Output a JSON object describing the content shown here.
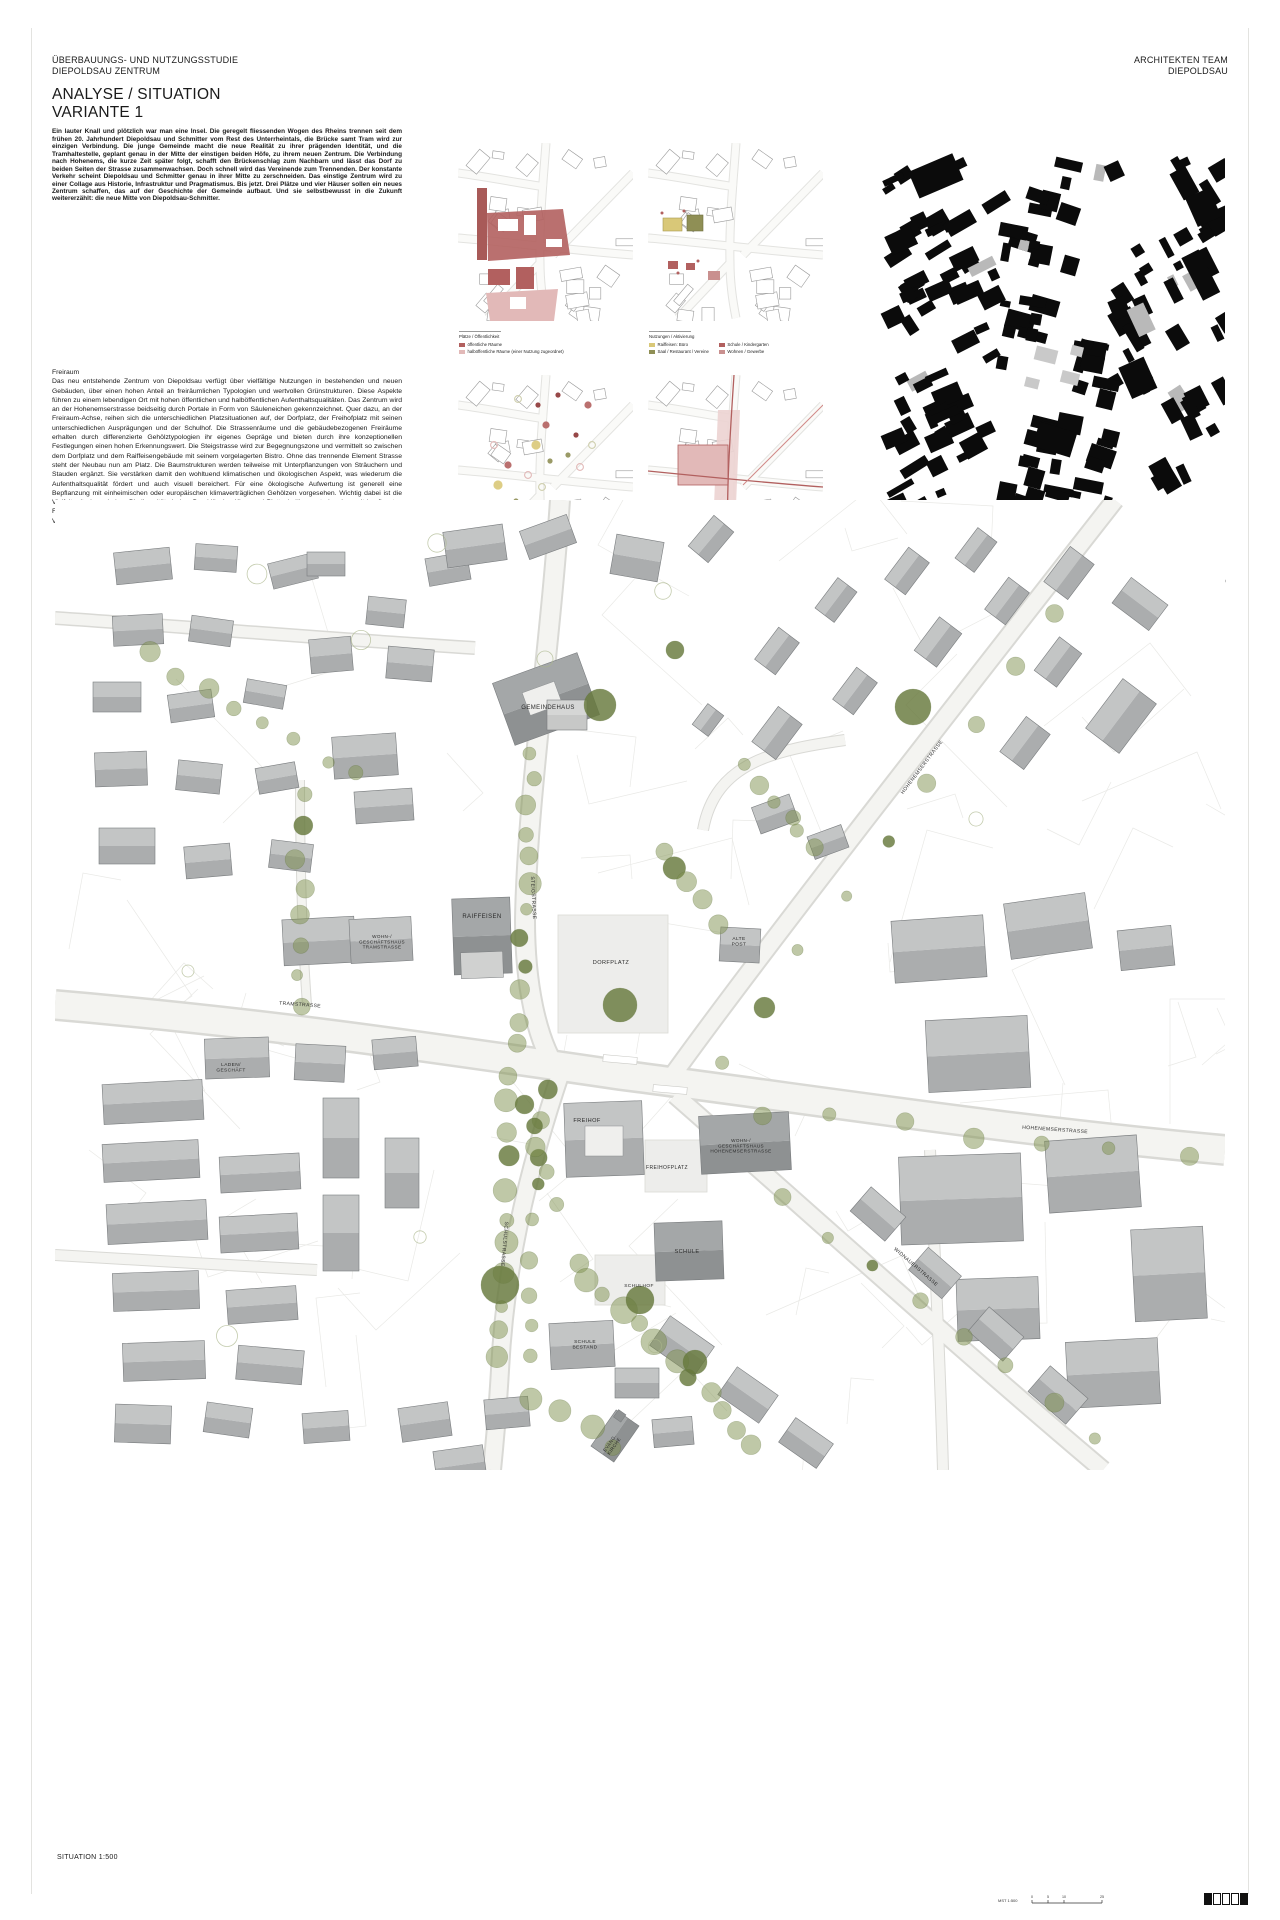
{
  "header": {
    "left1": "ÜBERBAUUNGS- UND NUTZUNGSSTUDIE",
    "left2": "DIEPOLDSAU ZENTRUM",
    "right1": "ARCHITEKTEN TEAM",
    "right2": "DIEPOLDSAU",
    "title1": "ANALYSE / SITUATION",
    "title2": "VARIANTE 1"
  },
  "intro_paragraph": "Ein lauter Knall und plötzlich war man eine Insel. Die geregelt fliessenden Wogen des Rheins trennen seit dem frühen 20. Jahrhundert Diepoldsau und Schmitter vom Rest des Unterrheintals, die Brücke samt Tram wird zur einzigen Verbindung. Die junge Gemeinde macht die neue Realität zu ihrer prägenden Identität, und die Tramhaltestelle, geplant genau in der Mitte der einstigen beiden Höfe, zu ihrem neuen Zentrum. Die Verbindung nach Hohenems, die kurze Zeit später folgt, schafft den Brückenschlag zum Nachbarn und lässt das Dorf zu beiden Seiten der Strasse zusammenwachsen. Doch schnell wird das Vereinende zum Trennenden. Der konstante Verkehr scheint Diepoldsau und Schmitter genau in ihrer Mitte zu zerschneiden. Das einstige Zentrum wird zu einer Collage aus Historie, Infrastruktur und Pragmatismus. Bis jetzt. Drei Plätze und vier Häuser sollen ein neues Zentrum schaffen, das auf der Geschichte der Gemeinde aufbaut. Und sie selbstbewusst in die Zukunft weitererzählt: die neue Mitte von Diepoldsau-Schmitter.",
  "freiraum": {
    "heading": "Freiraum",
    "body": "Das neu entstehende Zentrum von Diepoldsau verfügt über vielfältige Nutzungen in bestehenden und neuen Gebäuden, über einen hohen Anteil an freiräumlichen Typologien und wertvollen Grünstrukturen. Diese Aspekte führen zu einem lebendigen Ort mit hohen öffentlichen und halböffentlichen Aufenthaltsqualitäten. Das Zentrum wird an der Hohenemserstrasse beidseitig durch Portale in Form von Säuleneichen gekennzeichnet. Quer dazu, an der Freiraum-Achse, reihen sich die unterschiedlichen Platzsituationen auf, der Dorfplatz, der Freihofplatz mit seinen unterschiedlichen Ausprägungen und der Schulhof. Die Strassenräume und die gebäudebezogenen Freiräume erhalten durch differenzierte Gehölztypologien ihr eigenes Gepräge und bieten durch ihre konzeptionellen Festlegungen einen hohen Erkennungswert. Die Steigstrasse wird zur Begegnungszone und vermittelt so zwischen dem Dorfplatz und dem Raiffeisengebäude mit seinem vorgelagerten Bistro. Ohne das trennende Element Strasse steht der Neubau nun am Platz. Die Baumstrukturen werden teilweise mit Unterpflanzungen von Sträuchern und Stauden ergänzt. Sie verstärken damit den wohltuend klimatischen und ökologischen Aspekt, was wiederum die Aufenthaltsqualität fördert und auch visuell bereichert. Für eine ökologische Aufwertung ist generell eine Bepflanzung mit einheimischen oder europäischen klimaverträglichen Gehölzen vorgesehen. Wichtig dabei ist die Vielfalt mit einem hohen Biodiversitäts-Index. Durchlässige Kies- und Plattenbeläge, unterbrochen mit bepflanzten Fugen sowie Retentionsmulden und extensive Dachbegrünungen mit differenzierten Ansaaten tragen zur Verbesserung des Mikroklimas bei."
  },
  "legends": [
    {
      "cols": "c1",
      "title": "Plätze / Öffentlichkeit",
      "items": [
        {
          "shape": "rect",
          "color": "#b2605f",
          "label": "öffentliche Räume"
        },
        {
          "shape": "rect",
          "color": "#e2b9b8",
          "label": "halböffentliche Räume (einer Nutzung zugeordnet)"
        }
      ]
    },
    {
      "cols": "c2",
      "title": "Nutzungen / Aktivierung",
      "items": [
        {
          "shape": "rect",
          "color": "#d9c878",
          "label": "Raiffeisen: Büro"
        },
        {
          "shape": "rect",
          "color": "#8f8f55",
          "label": "Saal / Restaurant / Vereine"
        },
        {
          "shape": "rect",
          "color": "#b2605f",
          "label": "Schule / Kindergarten"
        },
        {
          "shape": "rect",
          "color": "#c9908f",
          "label": "Wohnen / Gewerbe"
        }
      ]
    },
    {
      "cols": "c3",
      "title": "Gehölzstrukturen",
      "items": [
        {
          "shape": "dot",
          "color": "#8c3434",
          "label": "Einzelbaum"
        },
        {
          "shape": "dot",
          "color": "#b2605f",
          "label": "Baumgruppen"
        },
        {
          "shape": "ring",
          "color": "#e2b9b8",
          "label": "Baumgruppen Aufenthalt"
        },
        {
          "shape": "dot",
          "color": "#d9c878",
          "label": "Solitärbaum"
        },
        {
          "shape": "dot",
          "color": "#8f8f55",
          "label": "Baumreihen"
        },
        {
          "shape": "ring",
          "color": "#cfcfae",
          "label": "Baumbestand"
        }
      ]
    },
    {
      "cols": "c1",
      "title": "Durchwegung",
      "items": [
        {
          "shape": "rect",
          "color": "#b2605f",
          "label": "Wege"
        },
        {
          "shape": "rect",
          "color": "#e2b9b8",
          "label": "Plätze"
        }
      ]
    }
  ],
  "schwarzplan": {
    "caption": "SCHWARZPLAN 1:2000"
  },
  "site_plan": {
    "scale_label": "SITUATION 1:500",
    "scalebar": {
      "prefix": "MST 1:500",
      "ticks": [
        "0",
        "5",
        "10",
        "25"
      ]
    },
    "labels": [
      {
        "id": "gemeindehaus",
        "text": "GEMEINDEHAUS",
        "x": 493,
        "y": 209,
        "size": 6,
        "rot": 0
      },
      {
        "id": "raiffeisen",
        "text": "RAIFFEISEN",
        "x": 427,
        "y": 418,
        "size": 6,
        "rot": 0
      },
      {
        "id": "wohnhaus-west",
        "text": "WOHN-/\nGESCHÄFTSHAUS\nTRAMSTRASSE",
        "x": 327,
        "y": 438,
        "size": 4.6,
        "rot": 0
      },
      {
        "id": "alte-post",
        "text": "ALTE\nPOST",
        "x": 684,
        "y": 440,
        "size": 4.8,
        "rot": 0
      },
      {
        "id": "dorfplatz",
        "text": "DORFPLATZ",
        "x": 556,
        "y": 464,
        "size": 5.6,
        "rot": 0
      },
      {
        "id": "tramstrasse",
        "text": "TRAMSTRASSE",
        "x": 245,
        "y": 506,
        "size": 5,
        "rot": 4
      },
      {
        "id": "steigstrasse",
        "text": "STEIGSTRASSE",
        "x": 477,
        "y": 398,
        "size": 5,
        "rot": 87
      },
      {
        "id": "laden",
        "text": "LADEN/\nGESCHÄFT",
        "x": 176,
        "y": 566,
        "size": 4.8,
        "rot": 0
      },
      {
        "id": "freihof",
        "text": "FREIHOF",
        "x": 532,
        "y": 622,
        "size": 5.6,
        "rot": 0
      },
      {
        "id": "freihofplatz",
        "text": "FREIHOFPLATZ",
        "x": 612,
        "y": 669,
        "size": 5,
        "rot": 0
      },
      {
        "id": "wgh-hohenemserstrasse",
        "text": "WOHN-/\nGESCHÄFTSHAUS\nHOHENEMSERSTRASSE",
        "x": 686,
        "y": 642,
        "size": 4.6,
        "rot": 0
      },
      {
        "id": "hohenemserstrasse",
        "text": "HOHENEMSERSTRASSE",
        "x": 1000,
        "y": 631,
        "size": 5,
        "rot": 4
      },
      {
        "id": "hohenemserstrasse-ne",
        "text": "HOHENEMSERSTRASSE",
        "x": 868,
        "y": 268,
        "size": 5,
        "rot": -53
      },
      {
        "id": "schule",
        "text": "SCHULE",
        "x": 632,
        "y": 753,
        "size": 5.6,
        "rot": 0
      },
      {
        "id": "schulhof",
        "text": "SCHULHOF",
        "x": 584,
        "y": 787,
        "size": 4.8,
        "rot": 0
      },
      {
        "id": "schule-bestand",
        "text": "SCHULE\nBESTAND",
        "x": 530,
        "y": 843,
        "size": 4.8,
        "rot": 0
      },
      {
        "id": "widnauerstrasse",
        "text": "WIDNAUERSTRASSE",
        "x": 860,
        "y": 768,
        "size": 5,
        "rot": 41
      },
      {
        "id": "schulstrasse",
        "text": "SCHULSTRASSE",
        "x": 448,
        "y": 744,
        "size": 5,
        "rot": 95
      },
      {
        "id": "kirche",
        "text": "EVANG.\nKIRCHE",
        "x": 556,
        "y": 944,
        "size": 4.6,
        "rot": -55
      }
    ]
  },
  "colors": {
    "accent_red": "#b2605f",
    "accent_red_light": "#e2b9b8",
    "accent_yellow": "#d9c878",
    "accent_olive": "#8f8f55",
    "tree_green": "#7f914f",
    "tree_green_dark": "#66793c",
    "building_grey": "#b9bcbd",
    "plan_black": "#111111"
  }
}
